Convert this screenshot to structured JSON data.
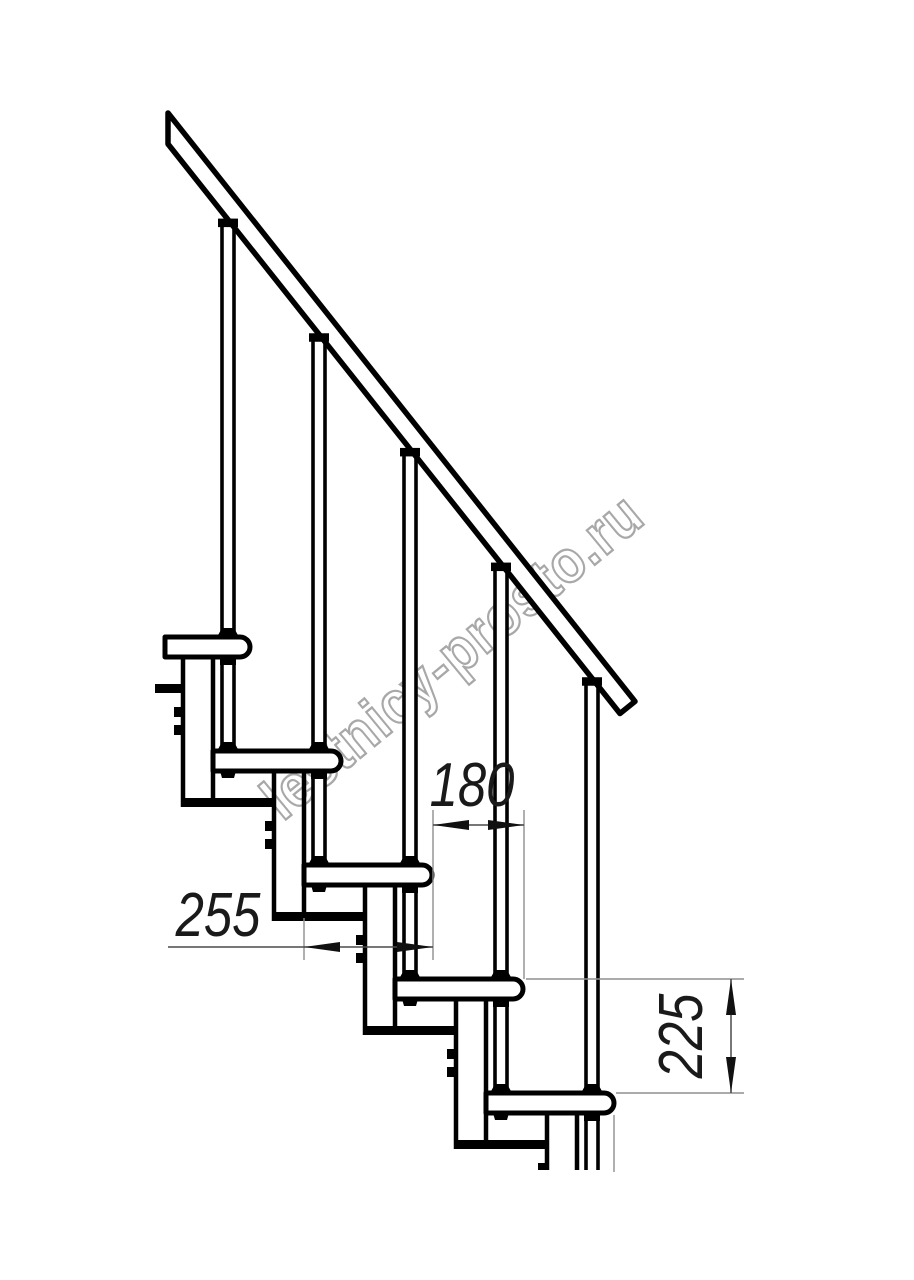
{
  "watermark": {
    "text": "lestnicy-prosto.ru",
    "color": "#a8a8a8",
    "rotation_deg": -39.5,
    "center_x": 452,
    "center_y": 656
  },
  "dimension_labels": {
    "run": "180",
    "depth": "255",
    "rise": "225"
  },
  "drawing": {
    "background": "#ffffff",
    "line_color": "#000000",
    "extension_color": "#8f8f8f",
    "dim_line_color": "#4a4a4a",
    "arrow_color": "#111111",
    "text_color": "#1a1a1a",
    "steps": {
      "count": 5,
      "first_nose_x": 250,
      "first_top_y": 637,
      "run_px": 91,
      "rise_px": 114,
      "tread_thickness": 20,
      "tread_length": 128,
      "nose_radius": 10,
      "first_left_cut_x": 165
    },
    "module": {
      "left_offset": 61,
      "width": 30,
      "plate_drop": 27,
      "plate_thickness": 9,
      "plate_width": 91,
      "bolt_offsets": [
        -44,
        -26
      ],
      "bolt_size": 10,
      "plate0": {
        "x": 155,
        "width": 28,
        "y": 684
      }
    },
    "rod": {
      "center_offset": 106,
      "half_gap": 6,
      "line_width": 3.6,
      "collar_w": 20,
      "collar_h": 8.5,
      "cone_h": 9,
      "cone_half_base": 11,
      "nut_w": 16,
      "nut_h": 8,
      "rear_nut_offset": 15
    },
    "rail": {
      "x_start": 168,
      "under_y_start": 144,
      "slope": 1.26,
      "band_height": 31,
      "x_end_under": 620,
      "cap_dx": 15,
      "cap_dy": 12.1,
      "stroke": 5.5
    },
    "bottom_cut_y": 1170,
    "dims": {
      "run": {
        "line_y": 825,
        "x1": 433,
        "x2": 524,
        "ext": [
          [
            433,
            810,
            960
          ],
          [
            524,
            810,
            979
          ]
        ],
        "text_x": 472,
        "text_y": 806
      },
      "depth": {
        "line_y": 947,
        "x_tail": 168,
        "x1": 304,
        "x2": 433,
        "ext": [
          [
            304,
            918,
            960
          ]
        ],
        "text_x": 218,
        "text_y": 936
      },
      "rise": {
        "line_x": 731,
        "y1": 979,
        "y2": 1093,
        "ext_h": [
          [
            979,
            526,
            744
          ],
          [
            1093,
            616,
            744
          ]
        ],
        "ext_v": [
          [
            614,
            1115,
            1172
          ]
        ],
        "text_x": 702,
        "text_y": 1036
      }
    },
    "arrow": {
      "length": 36,
      "half_width": 5
    },
    "strokes": {
      "tread": 5,
      "module": 4.5,
      "extension": 1.4,
      "dim": 1.5
    },
    "font_size_dim": 62
  }
}
